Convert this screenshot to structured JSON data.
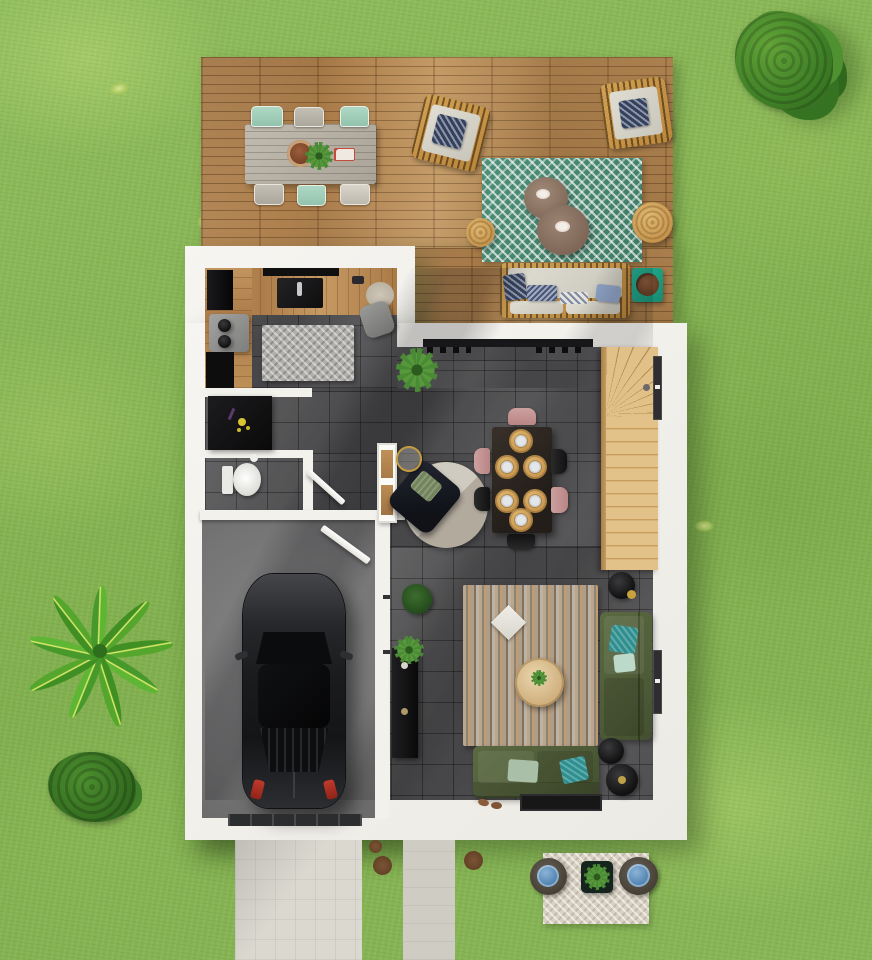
{
  "scene": {
    "title": "Top-down 3D floor plan render of a house with garden, terrace and garage",
    "environment": {
      "grass": {
        "label": "Lawn",
        "base_color": "#8fbc5c"
      },
      "tree_large": {
        "label": "Large bushy tree",
        "color": "#3f7f26"
      },
      "palm": {
        "label": "Palm plant",
        "color": "#5fb534"
      },
      "bush": {
        "label": "Garden bush",
        "color": "#3d7d27"
      },
      "driveway": {
        "label": "Concrete driveway",
        "color": "#dad7cf"
      },
      "path": {
        "label": "Garden path",
        "color": "#cfccc4"
      },
      "dirt_spots": {
        "label": "Dirt patches",
        "color": "#6e4a30"
      },
      "garden_seating": {
        "label": "Garden seating: chevron rug, two wicker chairs, black planter",
        "rug_color": "#ded6c8",
        "pillow_color": "#5d8cb8"
      }
    },
    "deck": {
      "label": "Wooden terrace",
      "wood_color": "#b5854f",
      "dining_table": {
        "label": "Outdoor dining table for six with bowl, plant and tray",
        "top_color": "#b9b3a8",
        "chair_colors": [
          "#9fd0ba",
          "#b9b4aa"
        ]
      },
      "lounge_rug": {
        "label": "Teal chevron outdoor rug",
        "color": "#47886f"
      },
      "wicker_chairs": {
        "label": "Two rattan lounge chairs with navy zigzag pillows",
        "frame_color": "#c08c3e",
        "pillow_color": "#33415e"
      },
      "coffee_tables": {
        "label": "Two round outdoor coffee tables",
        "color": "#8a7463"
      },
      "poufs": {
        "label": "Round jute poufs",
        "color": "#cda058"
      },
      "sofa": {
        "label": "Outdoor sofa with beige cushions and navy pillows",
        "cushion_color": "#ddd8cd"
      },
      "side_table": {
        "label": "Teal side table with round tray",
        "color": "#1ba183"
      }
    },
    "house": {
      "walls": {
        "label": "White exterior walls",
        "color": "#f2f1ec"
      },
      "floor": {
        "label": "Dark gray tile floor",
        "color": "#4e4e4f"
      },
      "kitchen": {
        "label": "Kitchen with L-shaped wooden counter, cooktop, sink, fridge and mat",
        "counter_color": "#b5854f",
        "mat_color": "#b4b2ae"
      },
      "dining": {
        "label": "Dining table with six jute placemats and chairs",
        "table_color": "#2e2622",
        "placemat_color": "#b5854a",
        "chair_colors": [
          "#c39090",
          "#20201f"
        ]
      },
      "lounge_corner": {
        "label": "Round rug with dark armchair and gold side table",
        "rug_color": "#c9c4b9",
        "armchair_color": "#15171e"
      },
      "stairs": {
        "label": "Wooden winder staircase",
        "color": "#d9b87c"
      },
      "sliding_door": {
        "label": "Sliding glass door to terrace"
      },
      "wc": {
        "label": "Guest WC with toilet"
      },
      "entry": {
        "label": "Entry with console shelf and black sideboard with yellow flowers",
        "sideboard_color": "#121212"
      },
      "garage": {
        "label": "Garage with dark parked car",
        "floor_color": "#7b7b7b",
        "car_color": "#232426",
        "door_color": "#2c2d2e"
      },
      "living": {
        "label": "Living room",
        "rug_label": "Striped multicolor rug with white diamond pillow",
        "sofa_color": "#55633e",
        "pillow_colors": [
          "#2f8f8e",
          "#bcd9c9",
          "#a9bfa8"
        ],
        "coffee_table_color": "#d8bd93",
        "tv_unit_color": "#131313",
        "lamp_label": "Black floor lamp",
        "doormat_color": "#171717"
      }
    }
  }
}
